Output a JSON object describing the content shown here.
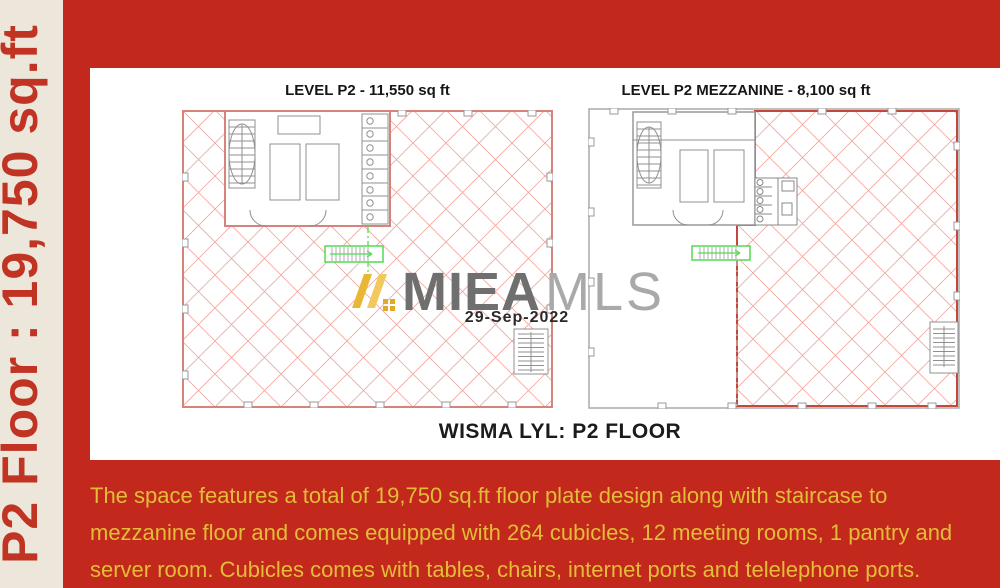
{
  "sidebar": {
    "vertical_label": "P2 Floor : 19,750 sq.ft"
  },
  "plans": {
    "left_title": "LEVEL P2 - 11,550 sq ft",
    "right_title": "LEVEL P2 MEZZANINE - 8,100 sq ft",
    "caption": "WISMA LYL: P2 FLOOR"
  },
  "watermark": {
    "brand_bold": "MIEA",
    "brand_light": "MLS",
    "date": "29-Sep-2022",
    "logo_icon": "miea-gold-stripes-logo"
  },
  "description": {
    "lines": [
      "The space features a total of 19,750 sq.ft floor plate design along with staircase to",
      "mezzanine floor and comes equipped with 264 cubicles, 12 meeting rooms, 1 pantry and",
      "server room. Cubicles comes with tables, chairs, internet ports and telelephone ports."
    ]
  },
  "colors": {
    "background_red": "#c2291c",
    "sidebar_cream": "#ece7da",
    "sidebar_text_red": "#c13322",
    "description_gold": "#e3bd38",
    "hatch_pink": "#f0a8a0",
    "plan_border_pink": "#d5837b",
    "mezzanine_border_red": "#c4473c",
    "wall_gray": "#909090",
    "watermark_dark_gray": "#6f6f6f",
    "watermark_light_gray": "#a9a9a9",
    "logo_gold": "#e9b32f",
    "stair_green": "#54d954"
  }
}
